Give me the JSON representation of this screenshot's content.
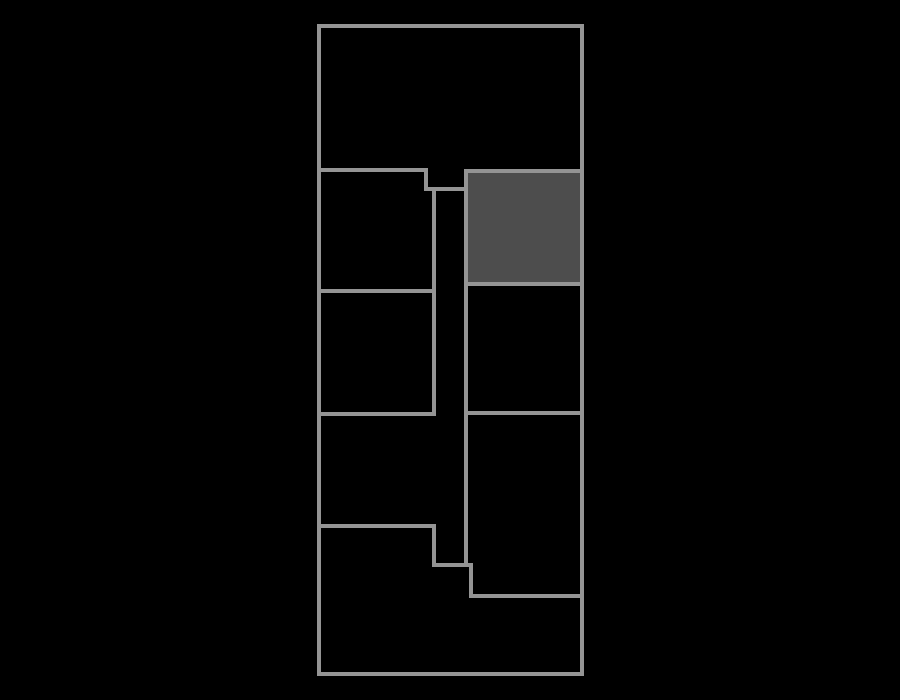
{
  "canvas": {
    "width": 900,
    "height": 700,
    "background": "#000000"
  },
  "floorplan": {
    "wall_color": "#949494",
    "wall_thickness": 4,
    "outline": {
      "x": 319,
      "y": 26,
      "width": 263,
      "height": 648
    },
    "highlighted_room": {
      "x": 466,
      "y": 171,
      "width": 116,
      "height": 113,
      "fill": "#4d4d4d",
      "stroke": "#949494"
    },
    "walls": [
      {
        "name": "top-room-bottom-wall",
        "x1": 319,
        "y1": 170,
        "x2": 426,
        "y2": 170
      },
      {
        "name": "top-notch-vertical-wall",
        "x1": 426,
        "y1": 170,
        "x2": 426,
        "y2": 189
      },
      {
        "name": "top-notch-bottom-wall",
        "x1": 426,
        "y1": 189,
        "x2": 464,
        "y2": 189
      },
      {
        "name": "corridor-left-wall",
        "x1": 434,
        "y1": 189,
        "x2": 434,
        "y2": 414
      },
      {
        "name": "left-rooms-divider-wall",
        "x1": 319,
        "y1": 291,
        "x2": 434,
        "y2": 291
      },
      {
        "name": "left-room2-bottom-wall",
        "x1": 319,
        "y1": 414,
        "x2": 434,
        "y2": 414
      },
      {
        "name": "corridor-right-wall",
        "x1": 466,
        "y1": 284,
        "x2": 466,
        "y2": 565
      },
      {
        "name": "right-rooms-divider-wall",
        "x1": 466,
        "y1": 413,
        "x2": 582,
        "y2": 413
      },
      {
        "name": "left-room3-bottom-wall",
        "x1": 319,
        "y1": 526,
        "x2": 434,
        "y2": 526
      },
      {
        "name": "bottom-step-vertical-wall-1",
        "x1": 434,
        "y1": 526,
        "x2": 434,
        "y2": 565
      },
      {
        "name": "bottom-step-horizontal-wall",
        "x1": 434,
        "y1": 565,
        "x2": 471,
        "y2": 565
      },
      {
        "name": "bottom-step-vertical-wall-2",
        "x1": 471,
        "y1": 565,
        "x2": 471,
        "y2": 596
      },
      {
        "name": "bottom-room-top-wall",
        "x1": 471,
        "y1": 596,
        "x2": 582,
        "y2": 596
      }
    ]
  }
}
